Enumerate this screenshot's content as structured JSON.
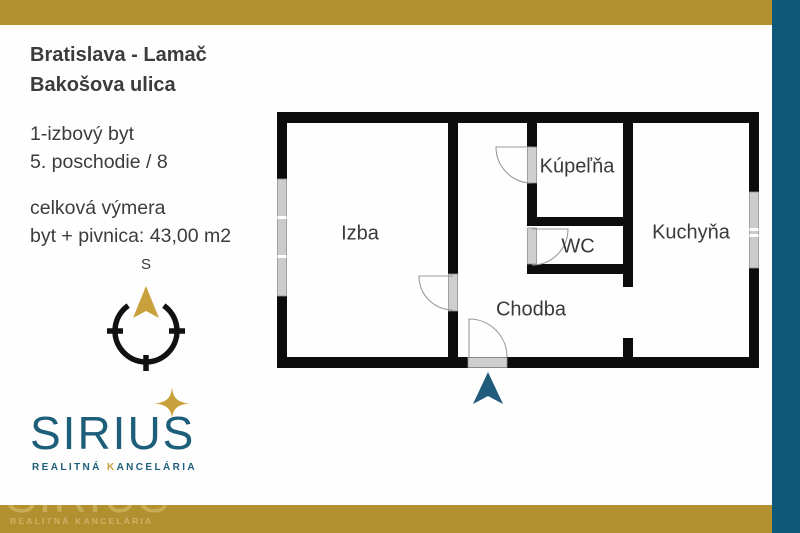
{
  "header": {
    "line1": "Bratislava - Lamač",
    "line2": "Bakošova ulica"
  },
  "details": {
    "flat_type": "1-izbový byt",
    "floor": "5. poschodie / 8",
    "area_label": "celková výmera",
    "area_value": "byt + pivnica: 43,00 m2"
  },
  "compass": {
    "north_label": "S"
  },
  "floor_plan": {
    "rooms": [
      {
        "name": "Izba"
      },
      {
        "name": "Kúpeľňa"
      },
      {
        "name": "WC"
      },
      {
        "name": "Kuchyňa"
      },
      {
        "name": "Chodba"
      }
    ]
  },
  "logo": {
    "brand": "SIRIUS",
    "tagline_prefix": "REALITNÁ ",
    "tagline_k": "K",
    "tagline_suffix": "ANCELÁRIA"
  },
  "watermark": {
    "brand": "SIRIUS",
    "tagline": "REALITNÁ KANCELÁRIA"
  },
  "colors": {
    "frame_gold": "#B3902F",
    "teal_bar": "#0F587A",
    "logo_teal": "#1D5F7A",
    "gold_accent": "#C9A13C",
    "text": "#3C3C3C",
    "wall": "#0C0C0C",
    "entrance_arrow": "#1F5B7B",
    "window_gray": "#CCCCCC"
  }
}
